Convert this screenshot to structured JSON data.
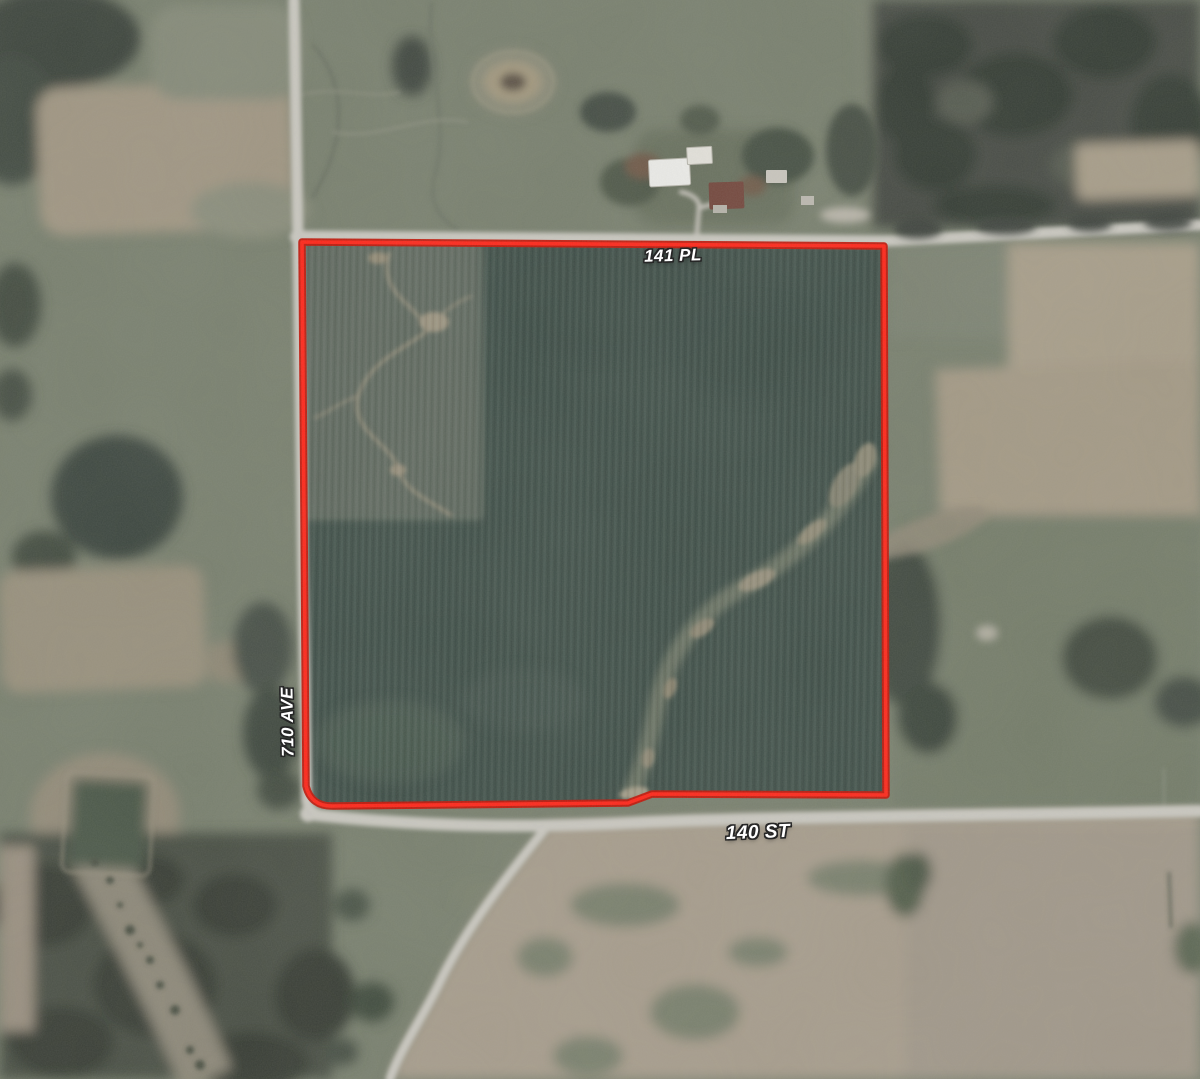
{
  "map": {
    "road_labels": {
      "top": "141 PL",
      "left": "710 AVE",
      "bottom": "140 ST"
    },
    "parcel": {
      "path": "M302,242 L884,246 L886,795 L652,794 L628,803 L334,806 Q311,807 306,786 Z",
      "fill_color": "#405049",
      "outline_color": "#c21508",
      "outline_highlight": "#ff2619"
    },
    "roads": {
      "surface_color": "#c9c7c0",
      "driveway_color": "#c3c0b8",
      "ave710_path": "M294,0 L298,242 L303,585 L307,800 C308,808 313,813 320,815",
      "pl141_path": "M296,236 L886,241 L1200,225",
      "st140_path": "M307,814 C430,828 540,828 650,822 C780,817 950,816 1200,811",
      "south_branch_path": "M549,824 C517,864 466,926 438,986 C421,1020 400,1050 390,1079",
      "driveway_path": "M697,233 L699,208 C700,199 691,194 681,192 M699,208 C712,204 722,202 734,202"
    }
  }
}
